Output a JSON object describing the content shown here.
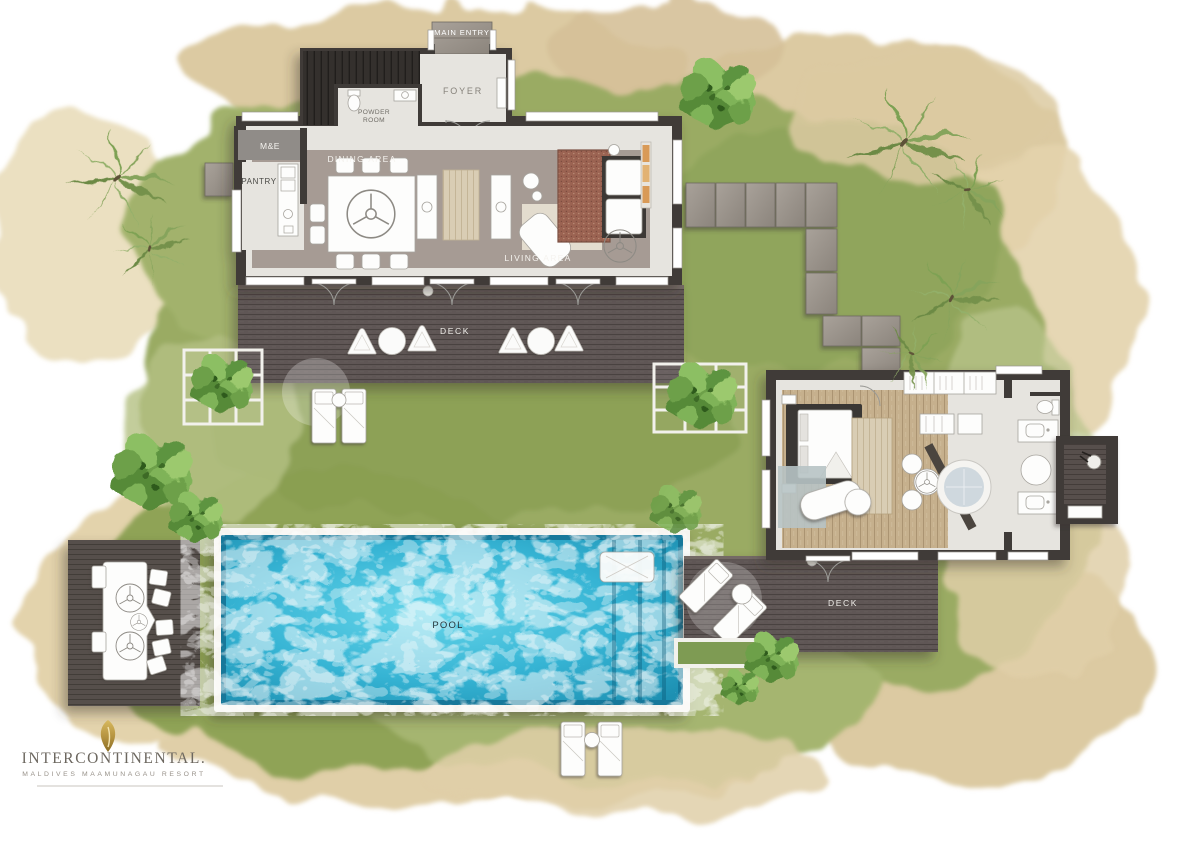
{
  "document": {
    "type": "resort-villa-floor-plan"
  },
  "labels": {
    "main_entry": "MAIN ENTRY",
    "foyer": "FOYER",
    "powder_room_line1": "POWDER",
    "powder_room_line2": "ROOM",
    "m_and_e": "M&E",
    "pantry": "PANTRY",
    "dining_area": "DINING AREA",
    "living_area": "LIVING AREA",
    "deck_main": "DECK",
    "deck_bedroom": "DECK",
    "pool": "POOL"
  },
  "brand": {
    "name_display": "INTERCONTINENTAL.",
    "tagline": "MALDIVES MAAMUNAGAU RESORT",
    "logo_icon": "gold-leaf-icon"
  },
  "icons": {
    "ceiling_fan": "ceiling-fan-icon",
    "shower_head": "shower-icon",
    "toilet": "toilet-icon",
    "bathtub": "round-bathtub-icon"
  },
  "colors": {
    "wall": "#3f3b38",
    "stone_floor": "#e6e4df",
    "taupe_floor": "#a69b94",
    "deck_wood": "#5f5755",
    "bedroom_wood": "#c4ae8c",
    "pool_water": "#36b4d4",
    "grass": "#9aab64",
    "sand": "#dfcda6",
    "logo_gold": "#b3913f"
  }
}
